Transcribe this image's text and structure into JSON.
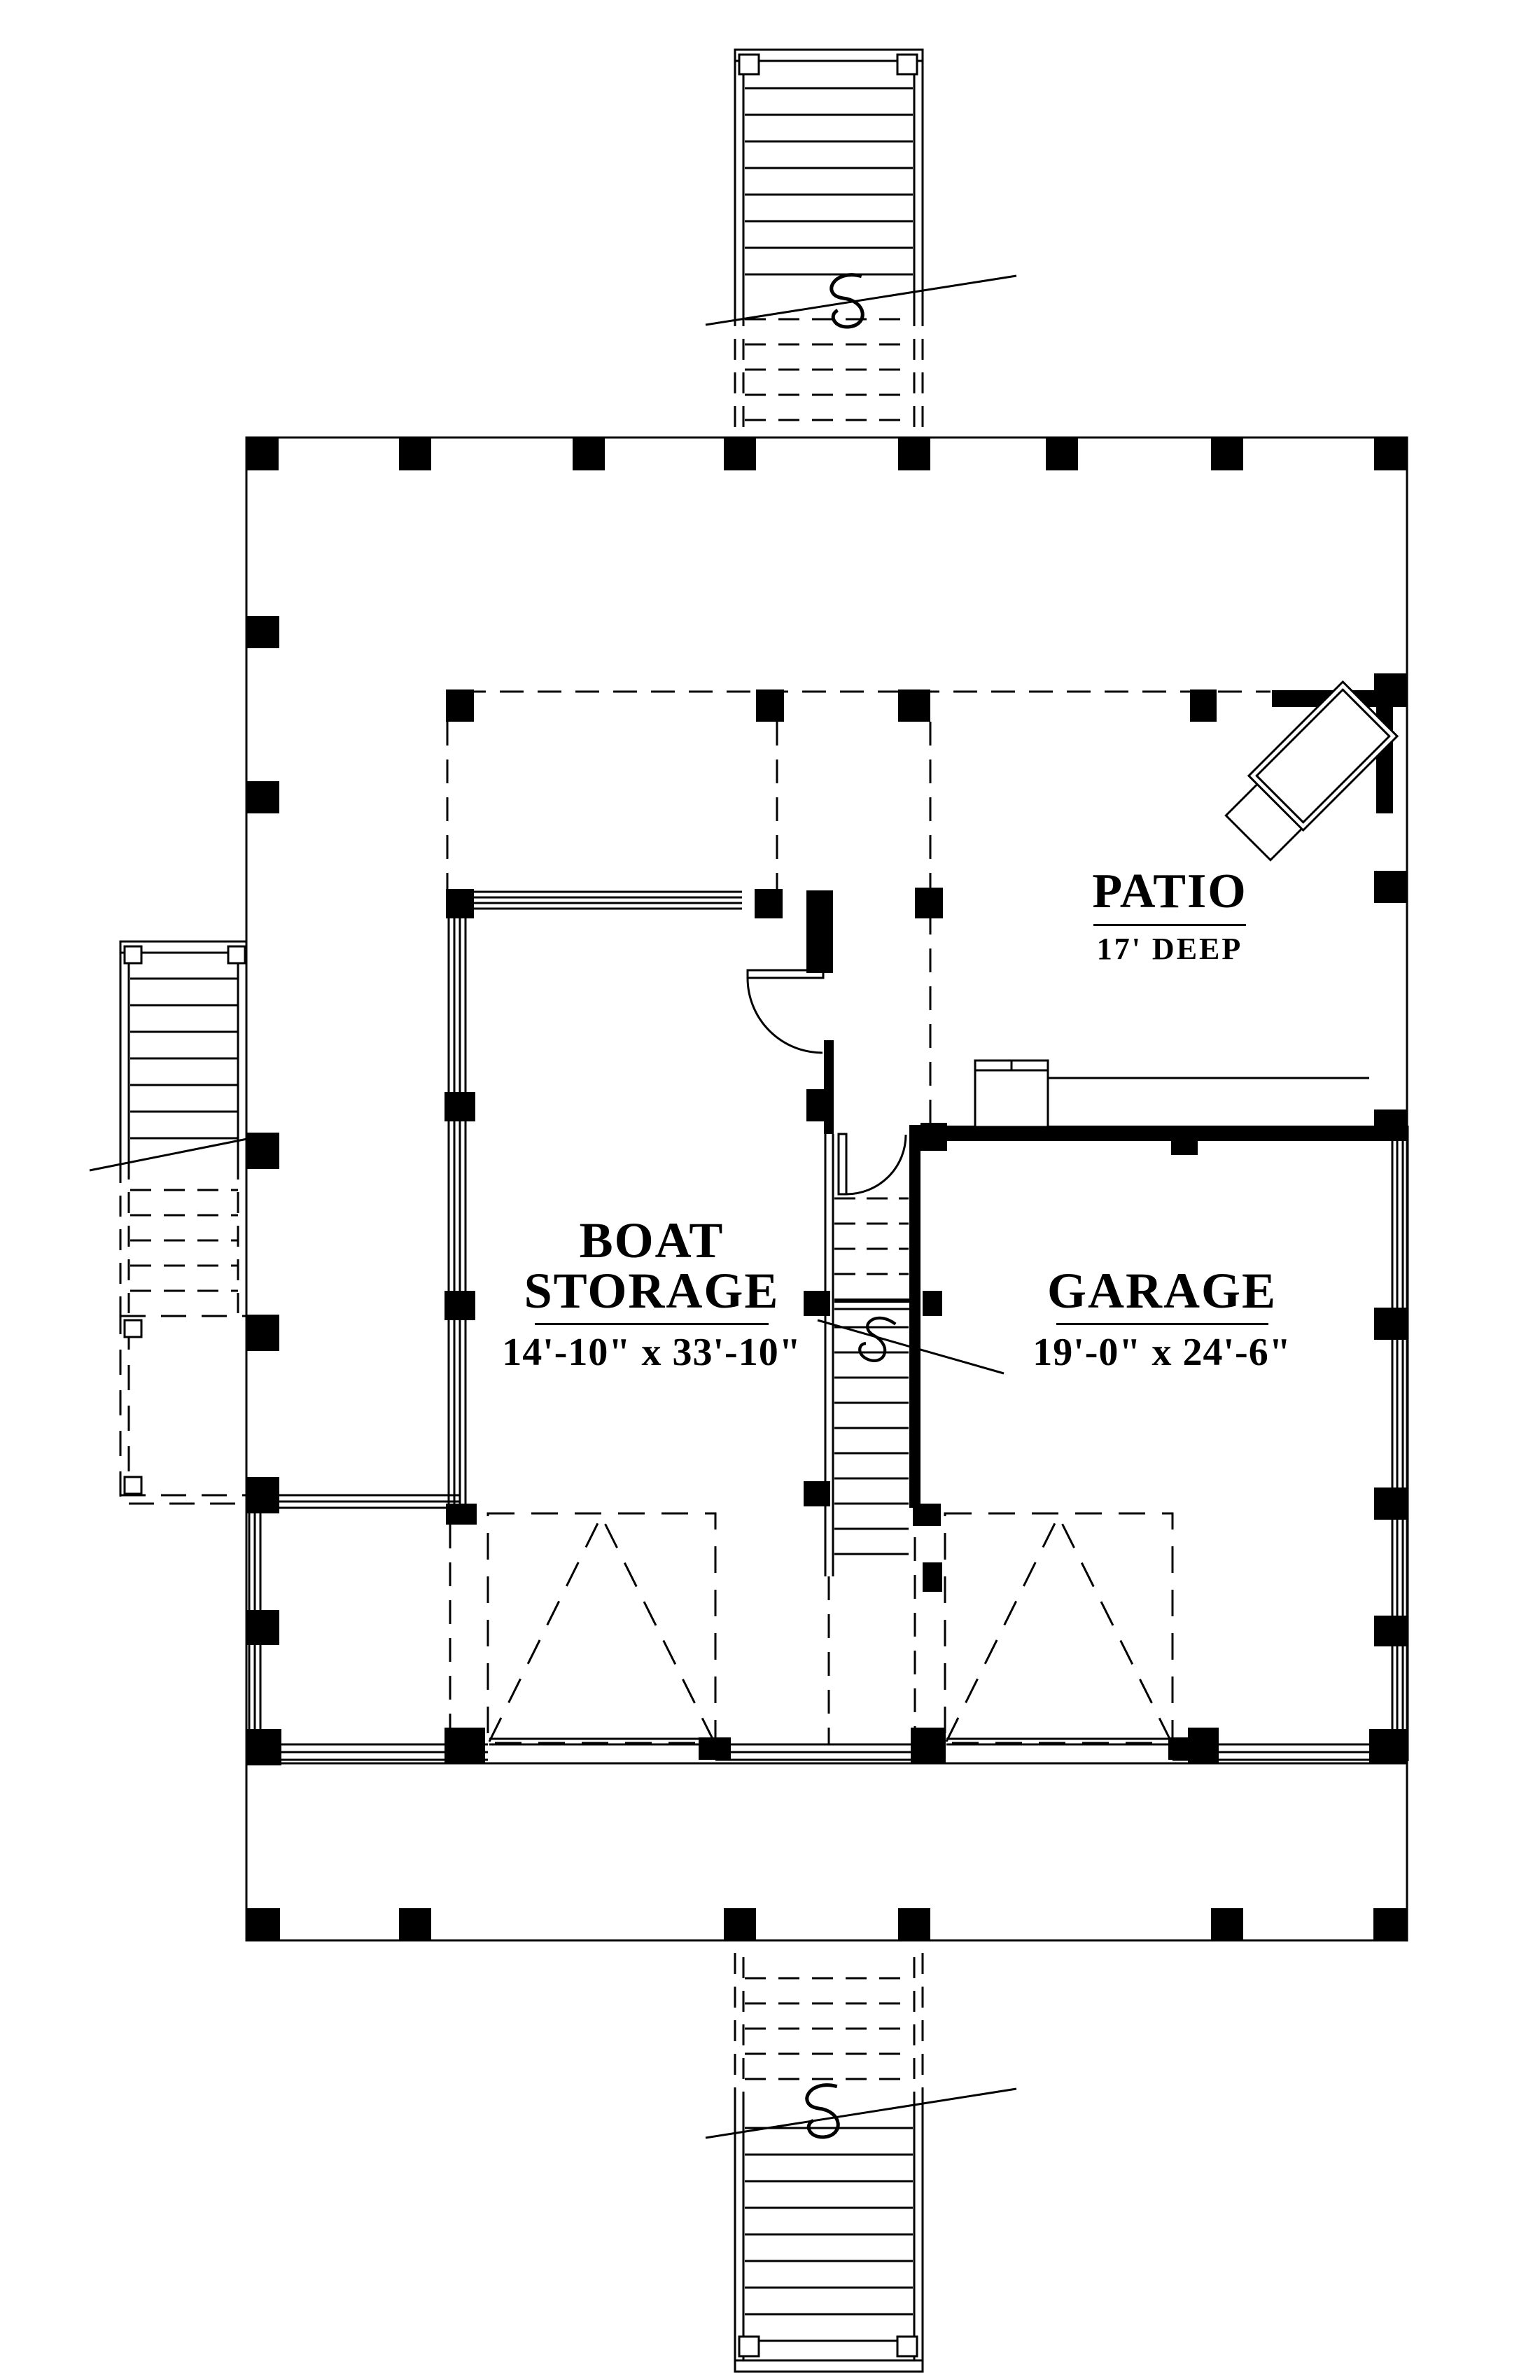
{
  "page": {
    "background": "#ffffff",
    "line_color": "#000000"
  },
  "plan": {
    "rooms": [
      {
        "name": "BOAT STORAGE",
        "dimensions": "14'-10\" x 33'-10\""
      },
      {
        "name": "GARAGE",
        "dimensions": "19'-0\" x 24'-6\""
      },
      {
        "name": "PATIO",
        "dimensions": "17' DEEP"
      }
    ],
    "symbols": {
      "column_post": "solid-black-square",
      "section_break": "s-curve-on-diagonal-cut-line",
      "overhead_garage_door": "dashed-rectangle-with-dashed-v",
      "stairs": "parallel-tread-lines",
      "swing_door": "leaf-with-quarter-arc"
    }
  }
}
